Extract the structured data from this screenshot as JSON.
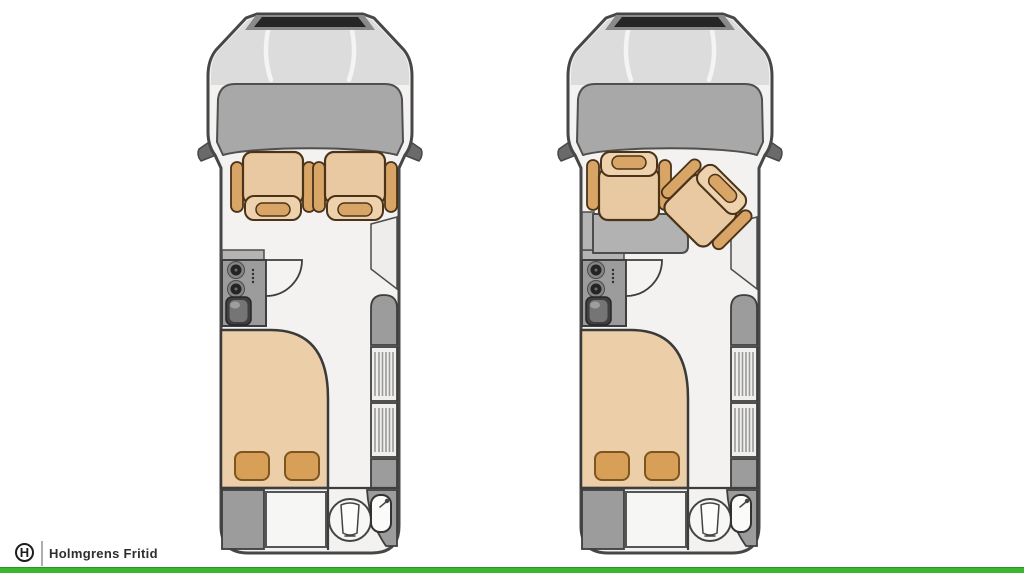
{
  "page": {
    "background": "#ffffff"
  },
  "footer": {
    "logo_monogram": "H",
    "logo_text": "Holmgrens Fritid"
  },
  "floorplans": [
    {
      "name": "campervan-floorplan-cab-seats-forward",
      "cab_seats": [
        "driver-seat-forward-facing",
        "passenger-seat-forward-facing"
      ],
      "features": [
        "side-mirrors",
        "kitchen-counter",
        "two-burner-stove",
        "kitchen-sink",
        "door-swing-arc",
        "overhead-cabinet",
        "side-cabinet",
        "entry-step",
        "rear-bed",
        "two-pillows",
        "rear-storage",
        "rear-locker",
        "toilet",
        "corner-washbasin"
      ]
    },
    {
      "name": "campervan-floorplan-cab-seats-swiveled-with-table",
      "cab_seats": [
        "driver-seat-swiveled-rear-facing",
        "passenger-seat-rotated-diagonal"
      ],
      "features": [
        "side-mirrors",
        "dinette-table",
        "kitchen-counter",
        "two-burner-stove",
        "kitchen-sink",
        "door-swing-arc",
        "overhead-cabinet",
        "side-cabinet",
        "entry-step",
        "rear-bed",
        "two-pillows",
        "rear-storage",
        "rear-locker",
        "toilet",
        "corner-washbasin"
      ]
    }
  ],
  "colors": {
    "outline": "#474747",
    "body": "#f3f2f0",
    "hood": "#dcdcdc",
    "grille": "#262626",
    "grilleframe": "#8a8a8a",
    "windshield": "#a8a8a8",
    "mirror": "#6a6a6a",
    "furn": "#9c9c9c",
    "furnlight": "#b4b4b4",
    "panel": "#eeedeb",
    "floor": "#f4f3f1",
    "stripe": "#9a9a9a",
    "seat": "#e9c9a2",
    "seatdark": "#d8a567",
    "seatback": "#edd2ad",
    "seatline": "#4a3318",
    "bed": "#eccfa9",
    "pillow": "#d89f58",
    "pillowline": "#7d551e",
    "green": "#3cb62e",
    "ink": "#1d1d1d",
    "textc": "#2e2e2e"
  }
}
